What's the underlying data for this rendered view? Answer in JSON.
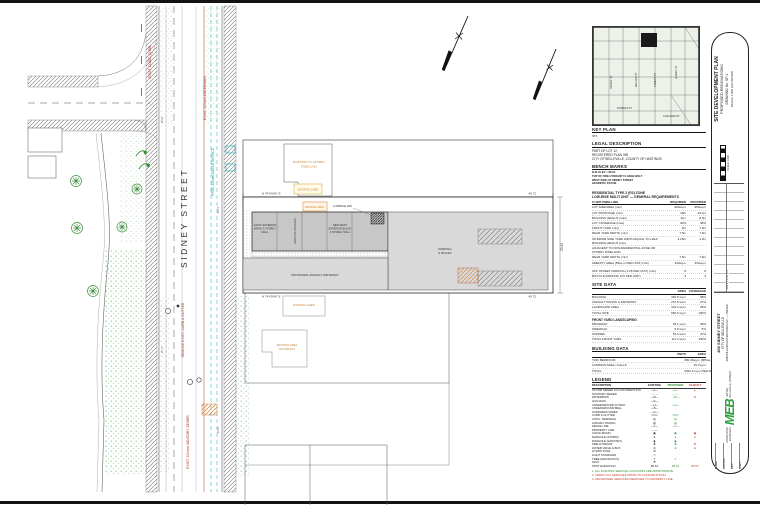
{
  "drawing": {
    "street_name": "SIDNEY STREET",
    "bearing_top": "N 74°09'40\" E",
    "dist_top": "45.72",
    "bearing_bottom": "N 74°09'40\" E",
    "dist_bottom": "45.72",
    "dim_right": "20.12",
    "neighbor_dwelling_1": "EXISTING 2½ STOREY",
    "neighbor_dwelling_2": "DWELLING",
    "neighbor_shed": "EXISTING SHED",
    "well_label": "EXISTING WELL",
    "wall_exist_1": "EXIST. EXTERIOR",
    "wall_exist_2": "BRICK 2 STOREY",
    "wall_exist_3": "WALL",
    "wall_new_1": "NEW WEST",
    "wall_new_2": "EXTERIOR BLOCK",
    "wall_new_3": "2 STOREY WALL",
    "unit_entrance": "NEW UNIT ENTRANCE",
    "garbage_pad": "GARBAGE PAD",
    "parking_1": "PARKING",
    "parking_2": "8 SPACES",
    "driveway_label": "PROPOSED ASPHALT DRIVEWAY",
    "south_shed": "EXISTING SHED",
    "south_asphalt_1": "EXISTING AREA",
    "south_asphalt_2": "OF ASPHALT",
    "red_watermain": "EXIST. 200mm WATERMAIN",
    "red_curb": "REMOVE EXIST. CURB & GUTTER",
    "red_sanitary": "EXIST. 200mm SANITARY SEWER",
    "red_conc": "EXIST. CONC. CURB",
    "cyan_service": "PROP. 150mm WATER SERVICE",
    "elevations": [
      "86.64",
      "86.59",
      "86.71",
      "86.68"
    ]
  },
  "panel": {
    "key_plan": {
      "title": "KEY PLAN",
      "scale": "NTS",
      "streets": [
        "SIDNEY ST",
        "WILLIAM ST",
        "ALBERT ST",
        "DUNDAS ST",
        "QUEEN ST",
        "CHATHAM ST"
      ]
    },
    "legal": {
      "title": "LEGAL DESCRIPTION",
      "lines": [
        "PART OF LOT 12,",
        "REGISTERED PLAN 269",
        "CITY OF BELLEVILLE, COUNTY OF HASTINGS"
      ]
    },
    "bench": {
      "title": "BENCH MARKS",
      "lines": [
        "B.M. ELEV = 86.64",
        "TOP OF FIRE HYDRANT FLANGE BOLT",
        "WEST SIDE OF SIDNEY STREET",
        "GEODETIC DATUM"
      ]
    },
    "zoning": {
      "title1": "RESIDENTIAL TYPE 2 (R2) ZONE",
      "title2": "LOW-RISE MULTI UNIT — GENERAL REQUIREMENTS",
      "header": {
        "d": "6 UNIT DWELLING",
        "r": "REQUIRED",
        "p": "PROVIDED"
      },
      "rows": [
        {
          "d": "LOT SIZE/AREA (min)",
          "r": "900sq.m",
          "p": "952sq.m"
        },
        {
          "d": "LOT FRONTAGE (min)",
          "r": "18m",
          "p": "20.1m"
        },
        {
          "d": "BUILDING HEIGHT (max)",
          "r": "11m",
          "p": "8.5m"
        },
        {
          "d": "LOT COVERAGE (max)",
          "r": "40%",
          "p": "38%"
        },
        {
          "d": "FRONT YARD (min)",
          "r": "6m",
          "p": "7.5m"
        },
        {
          "d": "REAR YARD DEPTH (min)",
          "r": "7.5m",
          "p": "7.6m"
        },
        {
          "d": "INTERIOR SIDE YARD WIDTH EQUAL TO HALF BUILDING HEIGHT (min)",
          "r": "4.25m",
          "p": "4.3m"
        },
        {
          "d": "ADJACENT TO NON-RESIDENTIAL ZONE OR STOREY DWELLING",
          "r": "",
          "p": ""
        },
        {
          "d": "REAR YARD DEPTH (min)",
          "r": "7.5m",
          "p": "7.6m"
        },
        {
          "d": "AMENITY AREA (55sq.m PER UNIT) (min)",
          "r": "330sq.m",
          "p": "332sq.m"
        }
      ],
      "rows2": [
        {
          "d": "OFF STREET PARKING (1.25 PER UNIT) (min)",
          "r": "8",
          "p": "8"
        },
        {
          "d": "BICYCLE PARKING (0.5 PER UNIT)",
          "r": "3",
          "p": "3"
        }
      ]
    },
    "site_data": {
      "title": "SITE DATA",
      "header": {
        "d": "",
        "r": "AREA",
        "p": "COVERAGE"
      },
      "rows": [
        {
          "d": "BUILDING",
          "r": "362.5 sq.m",
          "p": "38%"
        },
        {
          "d": "ASPHALT PAVING & DRIVEWAY",
          "r": "257.8 sq.m",
          "p": "27%"
        },
        {
          "d": "LANDSCAPE AREA",
          "r": "332.2 sq.m",
          "p": "35%"
        },
        {
          "d": "TOTAL SITE",
          "r": "952.5 sq.m",
          "p": "100%"
        }
      ],
      "sub_title": "FRONT YARD LANDSCAPING",
      "rows2": [
        {
          "d": "DRIVEWAY",
          "r": "53.1 sq.m",
          "p": "48%"
        },
        {
          "d": "SIDEWALK",
          "r": "5.8 sq.m",
          "p": "5%"
        },
        {
          "d": "SODDED",
          "r": "52.3 sq.m",
          "p": "47%"
        },
        {
          "d": "TOTAL FRONT YARD",
          "r": "111.2 sq.m",
          "p": "100%"
        }
      ]
    },
    "building_data": {
      "title": "BUILDING DATA",
      "header": {
        "d": "",
        "r": "UNITS",
        "p": "AREA"
      },
      "rows": [
        {
          "d": "TWO BEDROOM",
          "r": "6",
          "p": "80.36sq.m (865sq.ft)"
        },
        {
          "d": "COMMON AREA / HALLS",
          "r": "",
          "p": "45.7sq.m"
        },
        {
          "d": "TOTAL",
          "r": "6",
          "p": "362.5 sq.m PER FLOOR"
        }
      ]
    },
    "legend": {
      "title": "LEGEND",
      "header": {
        "d": "DESCRIPTION",
        "e": "EXISTING",
        "p": "PROPOSED",
        "a": "AS-BUILT"
      },
      "rows": [
        {
          "d": "STORM SEWER & FLOW DIRECTION",
          "e": "—▸—",
          "p": "—▸—",
          "a": "▸"
        },
        {
          "d": "SANITARY SEWER",
          "e": "– – –",
          "p": "– – –",
          "a": ""
        },
        {
          "d": "WATERMAIN",
          "e": "—W—",
          "p": "—W—",
          "a": "W"
        },
        {
          "d": "GAS MAIN",
          "e": "—G—",
          "p": "",
          "a": ""
        },
        {
          "d": "UNDERGROUND HYDRO",
          "e": "—H—",
          "p": "—H—",
          "a": ""
        },
        {
          "d": "UNDERGROUND BELL",
          "e": "—B—",
          "p": "",
          "a": ""
        },
        {
          "d": "OVERHEAD WIRES",
          "e": "—O—",
          "p": "",
          "a": ""
        },
        {
          "d": "CURB & GUTTER",
          "e": "═══",
          "p": "═══",
          "a": ""
        },
        {
          "d": "CONC. SIDEWALK",
          "e": "▤",
          "p": "▤",
          "a": ""
        },
        {
          "d": "ASPHALT PAVING",
          "e": "▨",
          "p": "▨",
          "a": ""
        },
        {
          "d": "FENCE LINE",
          "e": "—x—",
          "p": "—x—",
          "a": ""
        },
        {
          "d": "PROPERTY LINE",
          "e": "—·—",
          "p": "",
          "a": ""
        },
        {
          "d": "CATCH BASIN",
          "e": "▣",
          "p": "▣",
          "a": "▣"
        },
        {
          "d": "MANHOLE (STORM)",
          "e": "●",
          "p": "●",
          "a": "●"
        },
        {
          "d": "MANHOLE (SANITARY)",
          "e": "◉",
          "p": "◉",
          "a": ""
        },
        {
          "d": "FIRE HYDRANT",
          "e": "✚",
          "p": "✚",
          "a": "✚"
        },
        {
          "d": "WATER VALVE & BOX",
          "e": "⊗",
          "p": "⊗",
          "a": "⊗"
        },
        {
          "d": "HYDRO POLE",
          "e": "Ø",
          "p": "",
          "a": ""
        },
        {
          "d": "LIGHT STANDARD",
          "e": "☉",
          "p": "",
          "a": ""
        },
        {
          "d": "TREE (DECIDUOUS)",
          "e": "✳",
          "p": "✳",
          "a": ""
        },
        {
          "d": "SIGN",
          "e": "⚑",
          "p": "",
          "a": ""
        },
        {
          "d": "SPOT ELEVATION",
          "e": "86.64",
          "p": "86.64",
          "a": "86.64"
        }
      ],
      "notes": [
        {
          "t": "1. ALL EXISTING SERVICE LOCATIONS ARE APPROXIMATE.",
          "c": "green"
        },
        {
          "t": "2. VERIFY ALL SERVICES PRIOR TO CONSTRUCTION.",
          "c": "red"
        },
        {
          "t": "3. ABANDONED SERVICES REMOVED TO PROPERTY LINE.",
          "c": "red"
        }
      ]
    }
  },
  "titleblock": {
    "titles": [
      "SITE DEVELOPMENT PLAN",
      "PROPOSED RENOVATIONS",
      "DRAWING No. SP-1",
      "SCALE 1:200 (AS NOTED)"
    ],
    "revisions_label": "REVISIONS",
    "scalebar_label": "SCALE 1:200",
    "project": [
      "400 SIDNEY STREET",
      "CITY OF BELLEVILLE",
      "JMB WILLIAMS ENTERPRISES INC. — OWNER"
    ],
    "logo": {
      "text": "MEB",
      "firm1": "CONSULTING",
      "firm2": "ENGINEERS",
      "sub": "LIMITED",
      "addr": "BELLEVILLE, ONTARIO"
    },
    "bottom": [
      "DRAWN",
      "CHECKED",
      "DATE",
      "SCALE"
    ]
  },
  "colors": {
    "proposed_green": "#2e8b2e",
    "asbuilt_red": "#c23b2b",
    "existing_orange": "#c87f2f",
    "water_cyan": "#18a8b8",
    "logo_green": "#2f9e3e"
  }
}
